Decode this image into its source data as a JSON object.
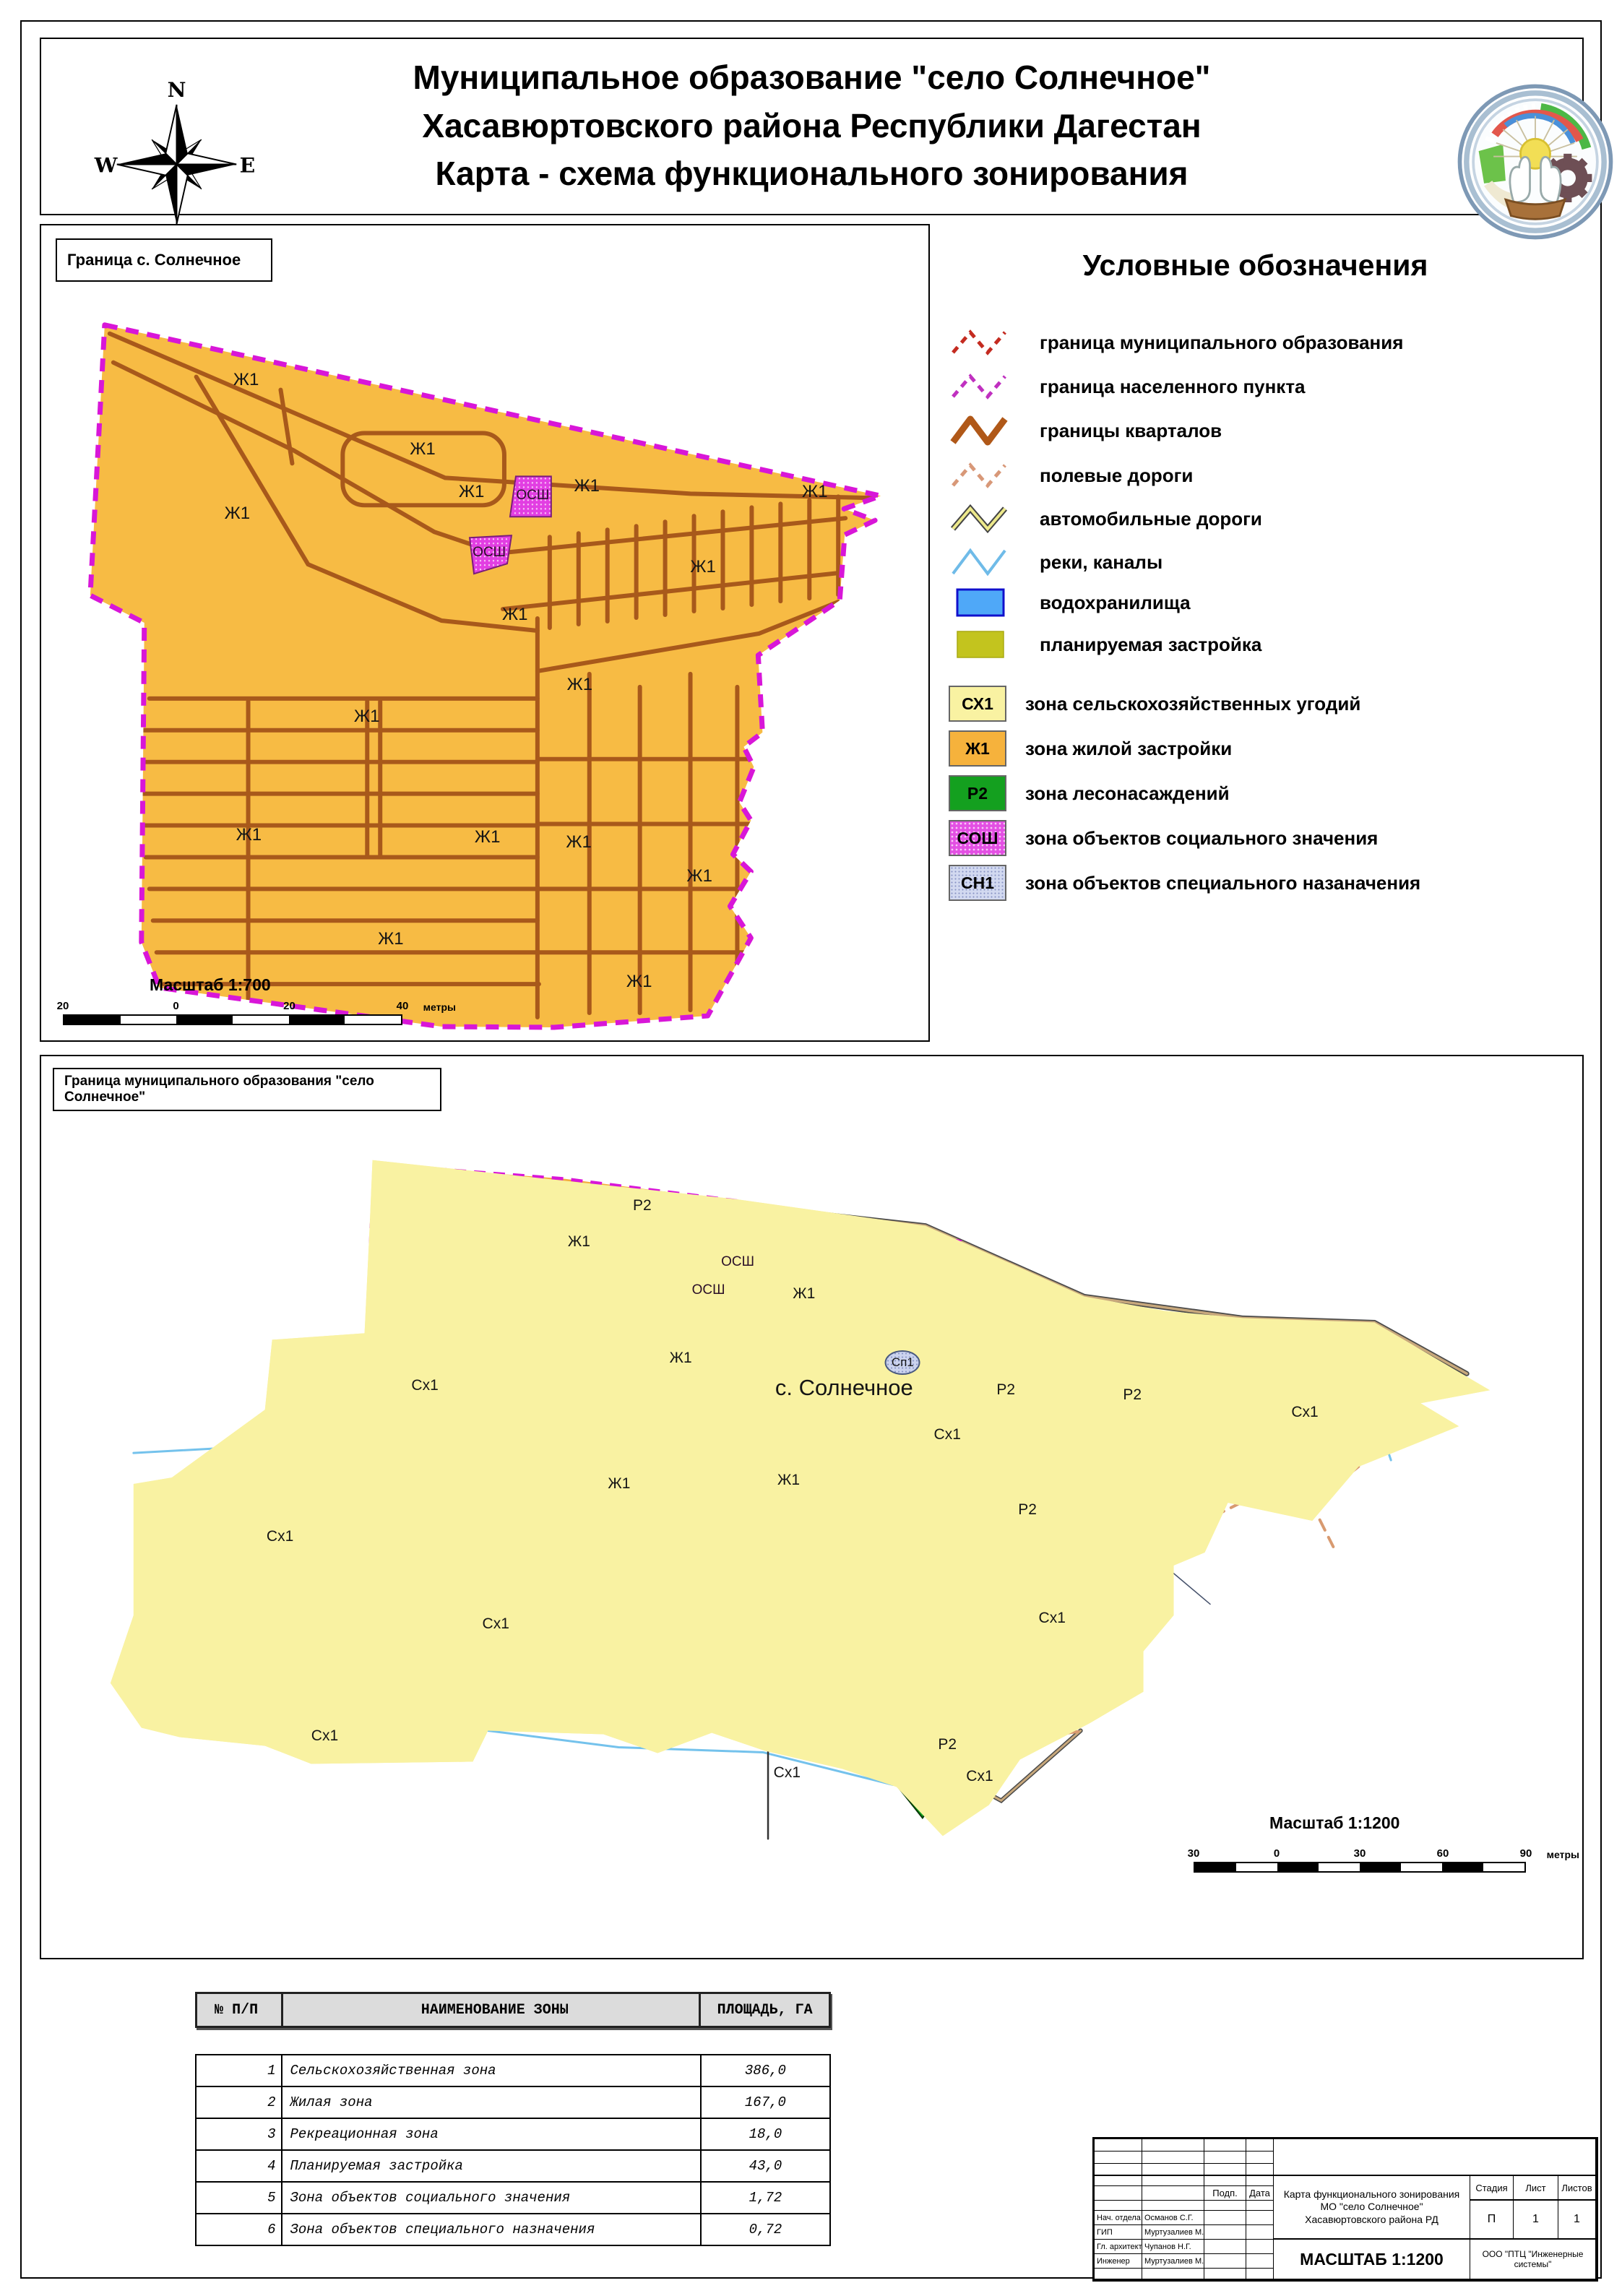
{
  "header": {
    "title_line1": "Муниципальное образование \"село Солнечное\"",
    "title_line2": "Хасавюртовского района Республики Дагестан",
    "title_line3": "Карта - схема функционального зонирования",
    "compass": {
      "n": "N",
      "s": "S",
      "e": "E",
      "w": "W"
    }
  },
  "legend": {
    "title": "Условные обозначения",
    "line_items": [
      {
        "label": "граница муниципального образования",
        "type": "dashed-zigzag",
        "color": "#c42b20"
      },
      {
        "label": "граница населенного пункта",
        "type": "dashed-zigzag",
        "color": "#c030c0"
      },
      {
        "label": "границы кварталов",
        "type": "zigzag",
        "color": "#b05818"
      },
      {
        "label": "полевые дороги",
        "type": "dashed-zigzag",
        "color": "#d89878"
      },
      {
        "label": "автомобильные дороги",
        "type": "zigzag-outline",
        "color": "#ede98b"
      },
      {
        "label": "реки, каналы",
        "type": "zigzag",
        "color": "#6fbbe8"
      },
      {
        "label": "водохранилища",
        "type": "rect",
        "color": "#4fa8f8",
        "border": "#1010cc"
      },
      {
        "label": "планируемая застройка",
        "type": "rect",
        "color": "#c3c41e",
        "border": "#a9aa10"
      }
    ],
    "zone_items": [
      {
        "code": "СХ1",
        "label": "зона сельскохозяйственных угодий",
        "color": "#f9f2a2"
      },
      {
        "code": "Ж1",
        "label": "зона жилой застройки",
        "color": "#f6b23c"
      },
      {
        "code": "Р2",
        "label": "зона лесонасаждений",
        "color": "#14a01f"
      },
      {
        "code": "СОШ",
        "label": "зона объектов социального значения",
        "color": "#e34fe3"
      },
      {
        "code": "СН1",
        "label": "зона объектов специального назаначения",
        "color": "#d2d9f0"
      }
    ]
  },
  "upper_map": {
    "box_label": "Граница с. Солнечное",
    "scale_label": "Масштаб 1:700",
    "scale_ticks": [
      "20",
      "0",
      "20",
      "40"
    ],
    "scale_unit": "метры",
    "labels": [
      {
        "text": "Ж1",
        "x": 23.1,
        "y": 19.0
      },
      {
        "text": "Ж1",
        "x": 43.0,
        "y": 27.5
      },
      {
        "text": "Ж1",
        "x": 22.1,
        "y": 35.4
      },
      {
        "text": "Ж1",
        "x": 48.5,
        "y": 32.7
      },
      {
        "text": "Ж1",
        "x": 61.5,
        "y": 32.0
      },
      {
        "text": "Ж1",
        "x": 87.2,
        "y": 32.7
      },
      {
        "text": "Ж1",
        "x": 74.6,
        "y": 41.9
      },
      {
        "text": "Ж1",
        "x": 53.4,
        "y": 47.8
      },
      {
        "text": "Ж1",
        "x": 60.7,
        "y": 56.4
      },
      {
        "text": "Ж1",
        "x": 36.7,
        "y": 60.3
      },
      {
        "text": "Ж1",
        "x": 23.4,
        "y": 74.8
      },
      {
        "text": "Ж1",
        "x": 50.3,
        "y": 75.1
      },
      {
        "text": "Ж1",
        "x": 60.6,
        "y": 75.7
      },
      {
        "text": "Ж1",
        "x": 74.2,
        "y": 79.9
      },
      {
        "text": "Ж1",
        "x": 39.4,
        "y": 87.6
      },
      {
        "text": "Ж1",
        "x": 67.4,
        "y": 92.8
      },
      {
        "text": "ОСШ",
        "x": 55.4,
        "y": 33.2,
        "cls": "osh"
      },
      {
        "text": "ОСШ",
        "x": 50.5,
        "y": 40.2,
        "cls": "osh"
      }
    ]
  },
  "lower_map": {
    "box_label": "Граница муниципального образования \"село Солнечное\"",
    "scale_label": "Масштаб 1:1200",
    "scale_ticks": [
      "30",
      "0",
      "30",
      "60",
      "90"
    ],
    "scale_unit": "метры",
    "labels": [
      {
        "text": "Р2",
        "x": 39.0,
        "y": 16.6,
        "cls": "r2"
      },
      {
        "text": "Ж1",
        "x": 34.9,
        "y": 20.6
      },
      {
        "text": "ОСШ",
        "x": 45.2,
        "y": 22.8,
        "cls": "osh"
      },
      {
        "text": "ОСШ",
        "x": 43.3,
        "y": 26.0,
        "cls": "osh"
      },
      {
        "text": "Ж1",
        "x": 49.5,
        "y": 26.4
      },
      {
        "text": "Ж1",
        "x": 41.5,
        "y": 33.5
      },
      {
        "text": "Сх1",
        "x": 24.9,
        "y": 36.5
      },
      {
        "text": "Сп1",
        "x": 55.9,
        "y": 34.0,
        "cls": "sp1"
      },
      {
        "text": "с. Солнечное",
        "x": 52.1,
        "y": 36.8,
        "cls": "village"
      },
      {
        "text": "Р2",
        "x": 62.6,
        "y": 37.0,
        "cls": "r2"
      },
      {
        "text": "Р2",
        "x": 70.8,
        "y": 37.6,
        "cls": "r2"
      },
      {
        "text": "Сх1",
        "x": 82.0,
        "y": 39.5
      },
      {
        "text": "Сх1",
        "x": 58.8,
        "y": 42.0
      },
      {
        "text": "Ж1",
        "x": 37.5,
        "y": 47.4
      },
      {
        "text": "Ж1",
        "x": 48.5,
        "y": 47.0
      },
      {
        "text": "Р2",
        "x": 64.0,
        "y": 50.3,
        "cls": "r2"
      },
      {
        "text": "Сх1",
        "x": 15.5,
        "y": 53.3
      },
      {
        "text": "Сх1",
        "x": 29.5,
        "y": 63.0
      },
      {
        "text": "Сх1",
        "x": 65.6,
        "y": 62.3
      },
      {
        "text": "Р2",
        "x": 58.8,
        "y": 76.4,
        "cls": "r2"
      },
      {
        "text": "Сх1",
        "x": 48.4,
        "y": 79.5
      },
      {
        "text": "Сх1",
        "x": 18.4,
        "y": 75.4
      },
      {
        "text": "Сх1",
        "x": 60.9,
        "y": 79.9
      }
    ]
  },
  "table": {
    "headers": [
      "№ П/П",
      "НАИМЕНОВАНИЕ ЗОНЫ",
      "ПЛОЩАДЬ, ГА"
    ],
    "rows": [
      {
        "num": "1",
        "name": "Сельскохозяйственная зона",
        "area": "386,0"
      },
      {
        "num": "2",
        "name": "Жилая зона",
        "area": "167,0"
      },
      {
        "num": "3",
        "name": "Рекреационная зона",
        "area": "18,0"
      },
      {
        "num": "4",
        "name": "Планируемая застройка",
        "area": "43,0"
      },
      {
        "num": "5",
        "name": "Зона объектов социального значения",
        "area": "1,72"
      },
      {
        "num": "6",
        "name": "Зона объектов специального назначения",
        "area": "0,72"
      }
    ]
  },
  "stamp": {
    "podp": "Подп.",
    "data": "Дата",
    "roles": [
      {
        "role": "Нач. отдела",
        "name": "Османов С.Г."
      },
      {
        "role": "ГИП",
        "name": "Муртузалиев М.Х."
      },
      {
        "role": "Гл. архитект.",
        "name": "Чупанов Н.Г."
      },
      {
        "role": "Инженер",
        "name": "Муртузалиев М.Х."
      }
    ],
    "doc_title_l1": "Карта функционального зонирования",
    "doc_title_l2": "МО \"село Солнечное\"",
    "doc_title_l3": "Хасавюртовского района РД",
    "stage_h": "Стадия",
    "sheet_h": "Лист",
    "sheets_h": "Листов",
    "stage": "П",
    "sheet": "1",
    "sheets": "1",
    "scale": "МАСШТАБ 1:1200",
    "org": "ООО \"ПТЦ \"Инженерные системы\""
  }
}
